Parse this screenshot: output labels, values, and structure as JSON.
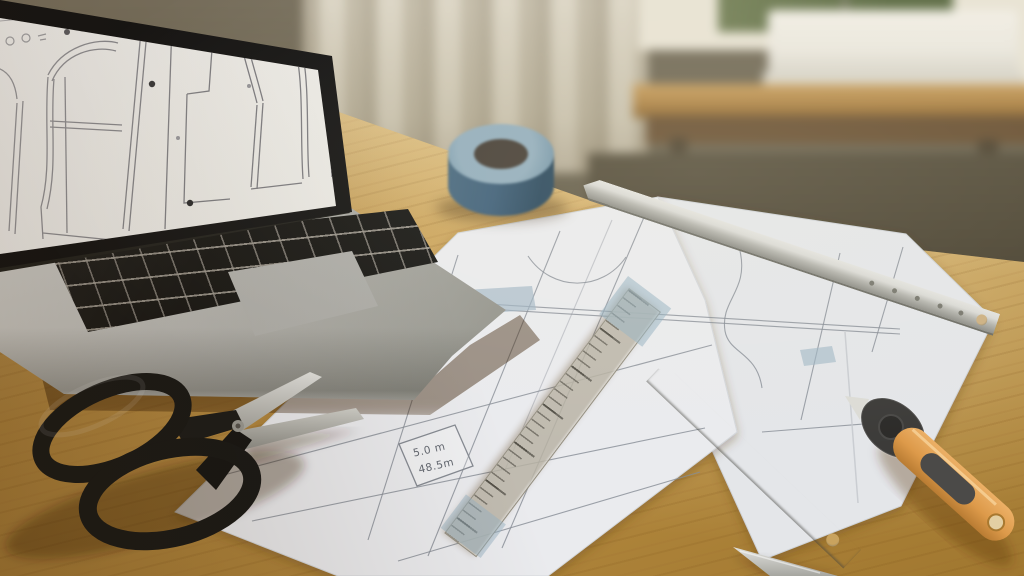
{
  "scene": {
    "label": "sewing-pattern-workspace-photo"
  },
  "pattern_label": {
    "line1": "5.0 m",
    "line2": "48.5m"
  },
  "colors": {
    "desk_wood": "#c2974b",
    "desk_dark": "#a0772f",
    "desk_light": "#e3c98f",
    "paper": "#e9eaed",
    "line_gray": "#8e939b",
    "tape_blue": "#3f607a",
    "tape_piece": "#9fb6c4",
    "metal_light": "#dadad6",
    "metal_dark": "#8e8e88",
    "cutter_orange": "#dd9a4a",
    "grip_gray": "#4b4a48",
    "scissors_black": "#1a1a19",
    "screen_white": "#edece8",
    "wall_olive": "#6e6754",
    "curtain_beige": "#d6cfbd",
    "window_frame": "#e8e3d4",
    "foliage_green": "#76825a",
    "table_wood": "#b0874a",
    "machine_white": "#eae7de"
  }
}
